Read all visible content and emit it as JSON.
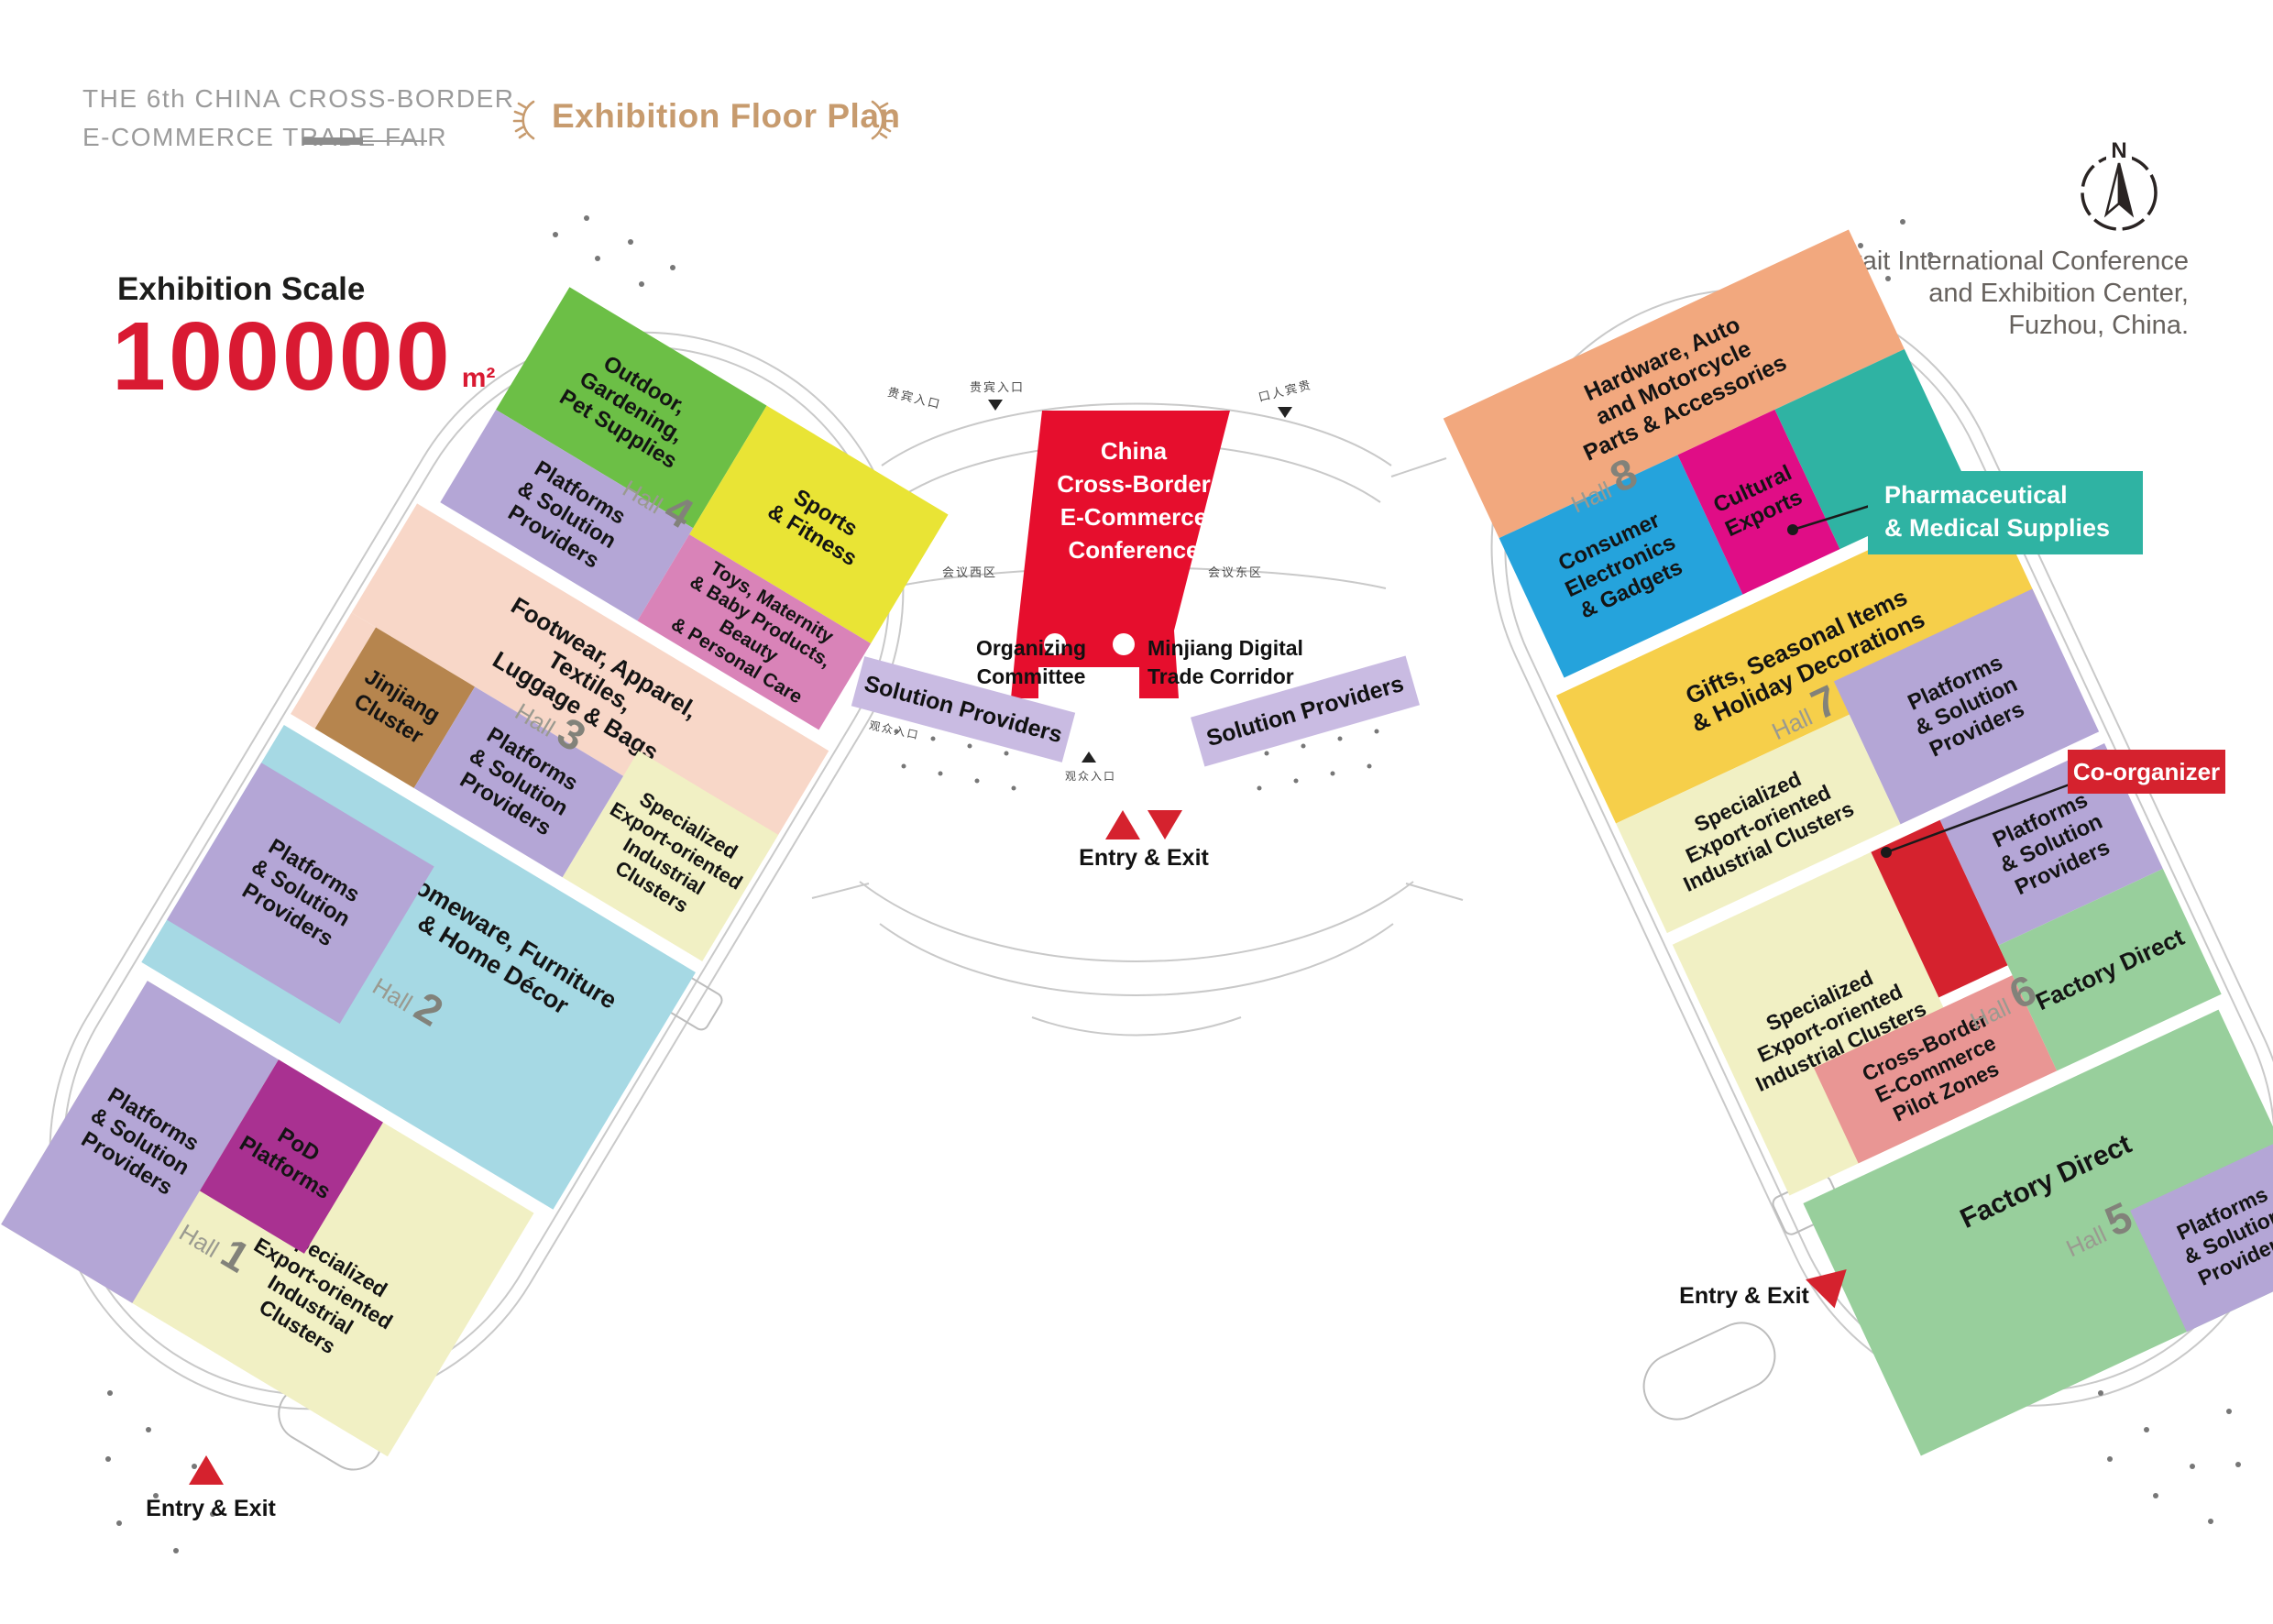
{
  "header": {
    "fair_name_line1": "THE 6th CHINA CROSS-BORDER",
    "fair_name_line2": "E-COMMERCE TRADE FAIR",
    "plan_title": "Exhibition Floor Plan"
  },
  "scale": {
    "label": "Exhibition Scale",
    "value": "100000",
    "unit": "m²"
  },
  "venue": {
    "compass_letter": "N",
    "address_line1": "Strait International Conference",
    "address_line2": "and Exhibition Center,",
    "address_line3": "Fuzhou, China."
  },
  "center_block": {
    "conference_line1": "China",
    "conference_line2": "Cross-Border",
    "conference_line3": "E-Commerce",
    "conference_line4": "Conference",
    "organizing_committee": "Organizing\nCommittee",
    "minjiang": "Minjiang Digital\nTrade Corridor",
    "solution_left": "Solution Providers",
    "solution_right": "Solution Providers"
  },
  "callouts": {
    "pharma": "Pharmaceutical\n& Medical Supplies",
    "coorganizer": "Co-organizer"
  },
  "entries": {
    "bottom_left": "Entry & Exit",
    "center": "Entry & Exit",
    "right": "Entry & Exit"
  },
  "wings": {
    "left": {
      "halls": [
        {
          "word": "Hall",
          "num": "4",
          "zones": {
            "outdoor": "Outdoor,\nGardening,\nPet Supplies",
            "sports": "Sports\n& Fitness",
            "platforms": "Platforms\n& Solution\nProviders",
            "toys": "Toys, Maternity\n& Baby Products,\nBeauty\n& Personal Care"
          }
        },
        {
          "word": "Hall",
          "num": "3",
          "zones": {
            "footwear": "Footwear, Apparel,\nTextiles,\nLuggage & Bags",
            "jinjiang": "Jinjiang\nCluster",
            "platforms": "Platforms\n& Solution\nProviders",
            "specialized": "Specialized\nExport-oriented\nIndustrial\nClusters"
          }
        },
        {
          "word": "Hall",
          "num": "2",
          "zones": {
            "homeware": "Homeware, Furniture\n& Home Décor",
            "platforms": "Platforms\n& Solution\nProviders"
          }
        },
        {
          "word": "Hall",
          "num": "1",
          "zones": {
            "platforms": "Platforms\n& Solution\nProviders",
            "pod": "PoD\nPlatforms",
            "specialized": "Specialized\nExport-oriented\nIndustrial\nClusters"
          }
        }
      ]
    },
    "right": {
      "halls": [
        {
          "word": "Hall",
          "num": "8",
          "zones": {
            "hardware": "Hardware, Auto\nand Motorcycle\nParts & Accessories",
            "consumer": "Consumer\nElectronics\n& Gadgets",
            "cultural": "Cultural\nExports"
          }
        },
        {
          "word": "Hall",
          "num": "7",
          "zones": {
            "gifts": "Gifts, Seasonal Items\n& Holiday Decorations",
            "specialized": "Specialized\nExport-oriented\nIndustrial Clusters",
            "platforms": "Platforms\n& Solution\nProviders"
          }
        },
        {
          "word": "Hall",
          "num": "6",
          "zones": {
            "specialized": "Specialized\nExport-oriented\nIndustrial Clusters",
            "platforms": "Platforms\n& Solution\nProviders",
            "pilot": "Cross-Border\nE-Commerce\nPilot Zones",
            "factory": "Factory Direct"
          }
        },
        {
          "word": "Hall",
          "num": "5",
          "zones": {
            "factory": "Factory Direct",
            "platforms": "Platforms\n& Solution\nProviders"
          }
        }
      ]
    }
  },
  "map_labels": {
    "vip_left": "贵宾入口",
    "vip_center": "贵宾入口",
    "vip_right": "口人宾贵",
    "meeting_west": "会议西区",
    "meeting_east": "会议东区",
    "audience_left": "观众入口",
    "audience_center": "观众入口"
  },
  "colors": {
    "accent_red": "#d91a32",
    "conference_red": "#e60e2d",
    "title_tan": "#c79b6e",
    "teal_pharma": "#2fb3a3",
    "coorganizer_red": "#d5222e",
    "outdoor_green": "#6cbf46",
    "sports_yellow": "#e9e435",
    "gifts_gold": "#f6cf4a",
    "platforms_purple": "#b4a6d6",
    "solution_band_purple": "#c9bbe2",
    "toys_pink": "#d983b8",
    "footwear_pink": "#f8d7c8",
    "jinjiang_brown": "#b6854e",
    "specialized_cream": "#f1f0c4",
    "homeware_blue": "#a6d9e4",
    "pod_magenta": "#a93191",
    "hardware_orange": "#f2a87e",
    "consumer_blue": "#25a3dc",
    "cultural_magenta": "#e00d86",
    "pilot_salmon": "#e99694",
    "factory_green": "#98cf9c"
  }
}
